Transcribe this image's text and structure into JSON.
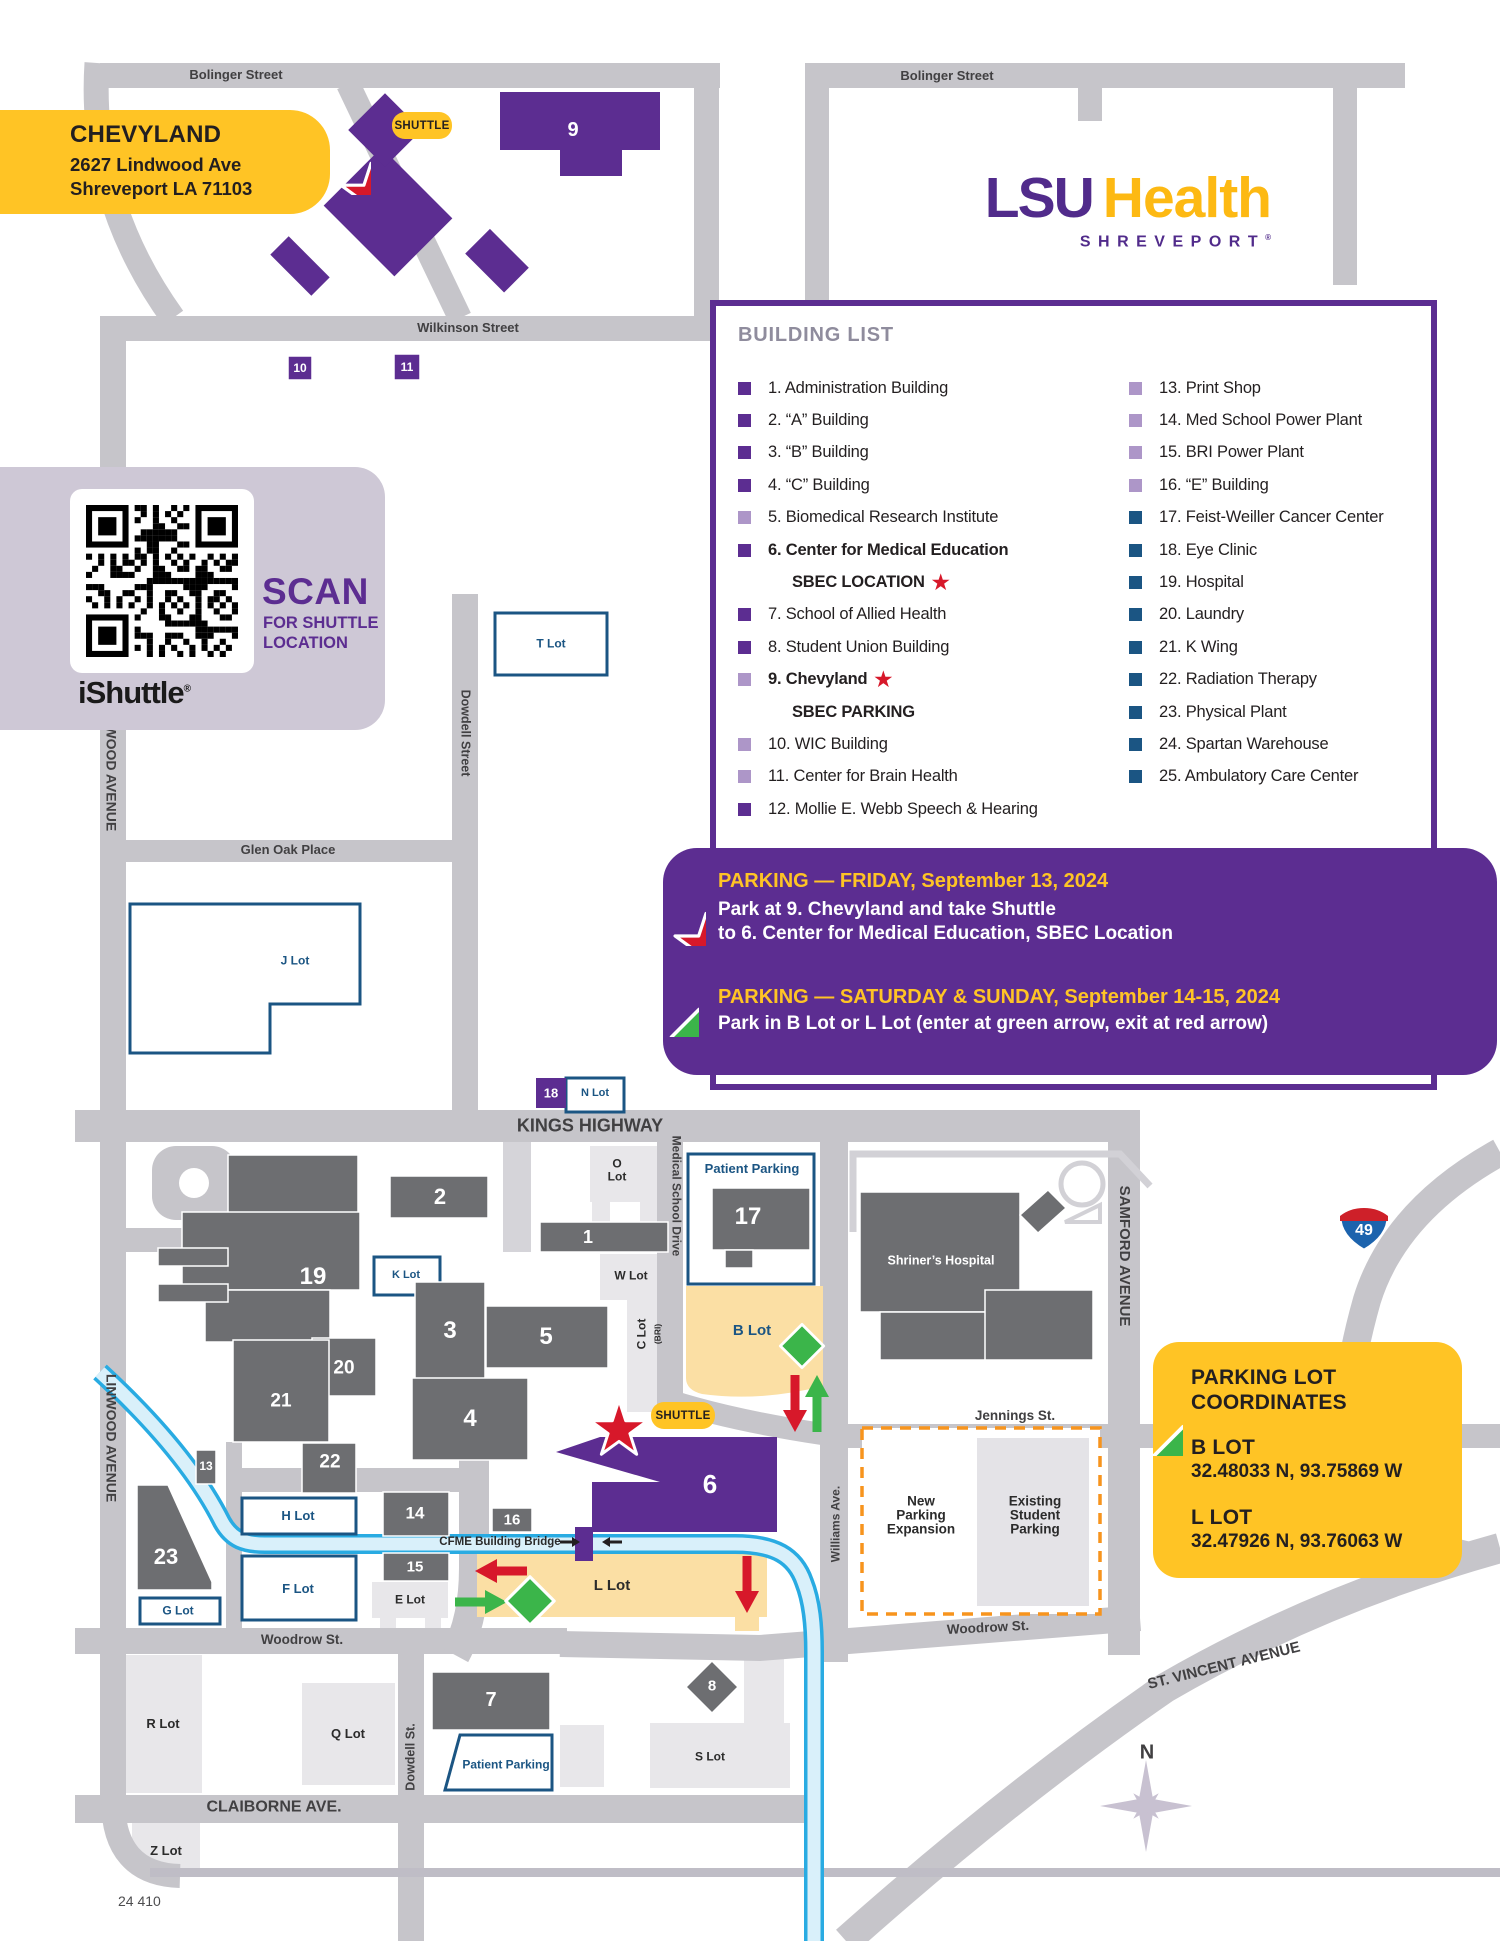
{
  "page": {
    "footer": "24 410"
  },
  "colors": {
    "purple": "#5C2D91",
    "light_purple": "#AD96C8",
    "navy": "#1B5583",
    "gold": "#FFC425",
    "logo_gold": "#FDB913",
    "red": "#D7182A",
    "green": "#3BB54A",
    "cyan": "#29ABE2",
    "orange": "#F7941D",
    "road_gray": "#C6C5CA",
    "building_gray": "#6D6E71",
    "lot_yellow": "#FBDFA4",
    "lavender": "#CEC8D6"
  },
  "logo": {
    "lsu": "LSU",
    "health": "Health",
    "sub": "SHREVEPORT",
    "reg": "®"
  },
  "callout": {
    "title": "CHEVYLAND",
    "line1": "2627 Lindwood Ave",
    "line2": "Shreveport LA 71103"
  },
  "shuttle_pill": "SHUTTLE",
  "qr_panel": {
    "scan": "SCAN",
    "sub1": "FOR SHUTTLE",
    "sub2": "LOCATION",
    "brand": "iShuttle",
    "reg": "®"
  },
  "building_list": {
    "title": "BUILDING LIST",
    "left": [
      {
        "text": "1. Administration Building",
        "bullet": "p"
      },
      {
        "text": "2. “A” Building",
        "bullet": "p"
      },
      {
        "text": "3. “B” Building",
        "bullet": "p"
      },
      {
        "text": "4. “C” Building",
        "bullet": "p"
      },
      {
        "text": "5. Biomedical Research Institute",
        "bullet": "lp"
      },
      {
        "text": "6. Center for Medical Education",
        "bullet": "p",
        "bold": true
      },
      {
        "text": "SBEC LOCATION",
        "sub": true,
        "star": true
      },
      {
        "text": "7. School of Allied Health",
        "bullet": "p"
      },
      {
        "text": "8. Student Union Building",
        "bullet": "p"
      },
      {
        "text": "9. Chevyland",
        "bullet": "lp",
        "bold": true,
        "star": true
      },
      {
        "text": "SBEC PARKING",
        "sub": true
      },
      {
        "text": "10. WIC Building",
        "bullet": "lp"
      },
      {
        "text": "11. Center for Brain Health",
        "bullet": "lp"
      },
      {
        "text": "12. Mollie E. Webb Speech & Hearing",
        "bullet": "p"
      }
    ],
    "right": [
      {
        "text": "13. Print Shop",
        "bullet": "lp"
      },
      {
        "text": "14. Med School Power Plant",
        "bullet": "lp"
      },
      {
        "text": "15. BRI Power Plant",
        "bullet": "lp"
      },
      {
        "text": "16. “E” Building",
        "bullet": "lp"
      },
      {
        "text": "17. Feist-Weiller Cancer Center",
        "bullet": "nb"
      },
      {
        "text": "18. Eye Clinic",
        "bullet": "nb"
      },
      {
        "text": "19. Hospital",
        "bullet": "nb"
      },
      {
        "text": "20. Laundry",
        "bullet": "nb"
      },
      {
        "text": "21. K Wing",
        "bullet": "nb"
      },
      {
        "text": "22. Radiation Therapy",
        "bullet": "nb"
      },
      {
        "text": "23. Physical Plant",
        "bullet": "nb"
      },
      {
        "text": "24. Spartan Warehouse",
        "bullet": "nb"
      },
      {
        "text": "25. Ambulatory Care Center",
        "bullet": "nb"
      }
    ]
  },
  "banner": {
    "friday_title": "PARKING — FRIDAY, September 13, 2024",
    "friday_line1": "Park at 9. Chevyland and take Shuttle",
    "friday_line2": "to 6. Center for Medical Education, SBEC Location",
    "weekend_title": "PARKING — SATURDAY & SUNDAY, September 14-15, 2024",
    "weekend_line1": "Park in B Lot or L Lot (enter at green arrow, exit at red arrow)"
  },
  "coords": {
    "title1": "PARKING LOT",
    "title2": "COORDINATES",
    "b_label": "B LOT",
    "b_value": "32.48033 N, 93.75869 W",
    "l_label": "L LOT",
    "l_value": "32.47926 N, 93.76063 W"
  },
  "map": {
    "labels": [
      {
        "n": "bolinger-street-label-1",
        "t": "Bolinger Street",
        "x": 236,
        "y": 75,
        "r": 0,
        "c": "st",
        "s": 13
      },
      {
        "n": "bolinger-street-label-2",
        "t": "Bolinger Street",
        "x": 947,
        "y": 76,
        "r": 0,
        "c": "st",
        "s": 13
      },
      {
        "n": "wilkinson-street-label",
        "t": "Wilkinson Street",
        "x": 468,
        "y": 328,
        "r": 0,
        "c": "st",
        "s": 13
      },
      {
        "n": "glen-oak-place-label",
        "t": "Glen Oak Place",
        "x": 288,
        "y": 850,
        "r": 0,
        "c": "st",
        "s": 13
      },
      {
        "n": "dowdell-street-label",
        "t": "Dowdell Street",
        "x": 465,
        "y": 733,
        "r": 90,
        "c": "st",
        "s": 12.5
      },
      {
        "n": "linwood-avenue-label-1",
        "t": "LINWOOD AVENUE",
        "x": 111,
        "y": 767,
        "r": 90,
        "c": "st",
        "s": 14
      },
      {
        "n": "linwood-avenue-label-2",
        "t": "LINWOOD AVENUE",
        "x": 111,
        "y": 1438,
        "r": 90,
        "c": "st",
        "s": 14
      },
      {
        "n": "kings-highway-label",
        "t": "KINGS HIGHWAY",
        "x": 590,
        "y": 1126,
        "r": 0,
        "c": "st",
        "s": 18
      },
      {
        "n": "medical-school-drive-label",
        "t": "Medical School Drive",
        "x": 676,
        "y": 1196,
        "r": 90,
        "c": "st",
        "s": 12
      },
      {
        "n": "samford-avenue-label",
        "t": "SAMFORD AVENUE",
        "x": 1124,
        "y": 1256,
        "r": 90,
        "c": "st",
        "s": 15
      },
      {
        "n": "jennings-st-label",
        "t": "Jennings St.",
        "x": 1015,
        "y": 1416,
        "r": 0,
        "c": "st",
        "s": 13.5
      },
      {
        "n": "williams-ave-label",
        "t": "Williams Ave.",
        "x": 836,
        "y": 1524,
        "r": -90,
        "c": "st",
        "s": 12
      },
      {
        "n": "woodrow-st-label-1",
        "t": "Woodrow St.",
        "x": 302,
        "y": 1640,
        "r": 0,
        "c": "st",
        "s": 13.5
      },
      {
        "n": "woodrow-st-label-2",
        "t": "Woodrow St.",
        "x": 988,
        "y": 1628,
        "r": -3,
        "c": "st",
        "s": 13.5
      },
      {
        "n": "claiborne-ave-label",
        "t": "CLAIBORNE AVE.",
        "x": 274,
        "y": 1808,
        "r": 0,
        "c": "st",
        "s": 16
      },
      {
        "n": "dowdell-st-label-2",
        "t": "Dowdell St.",
        "x": 411,
        "y": 1757,
        "r": -90,
        "c": "st",
        "s": 12.5
      },
      {
        "n": "st-vincent-avenue-label",
        "t": "ST. VINCENT AVENUE",
        "x": 1224,
        "y": 1666,
        "r": -14,
        "c": "st",
        "s": 15
      },
      {
        "n": "compass-n-label",
        "t": "N",
        "x": 1147,
        "y": 1753,
        "r": 0,
        "c": "st",
        "s": 20
      },
      {
        "n": "t-lot-label",
        "t": "T Lot",
        "x": 551,
        "y": 644,
        "r": 0,
        "c": "navy",
        "s": 12
      },
      {
        "n": "j-lot-label",
        "t": "J Lot",
        "x": 295,
        "y": 961,
        "r": 0,
        "c": "navy",
        "s": 12
      },
      {
        "n": "n-lot-label",
        "t": "N Lot",
        "x": 595,
        "y": 1094,
        "r": 0,
        "c": "navy",
        "s": 11
      },
      {
        "n": "k-lot-label",
        "t": "K Lot",
        "x": 406,
        "y": 1276,
        "r": 0,
        "c": "navy",
        "s": 11
      },
      {
        "n": "h-lot-label",
        "t": "H Lot",
        "x": 298,
        "y": 1516,
        "r": 0,
        "c": "navy",
        "s": 13
      },
      {
        "n": "f-lot-label",
        "t": "F Lot",
        "x": 298,
        "y": 1589,
        "r": 0,
        "c": "navy",
        "s": 13
      },
      {
        "n": "g-lot-label",
        "t": "G Lot",
        "x": 178,
        "y": 1611,
        "r": 0,
        "c": "navy",
        "s": 12
      },
      {
        "n": "b-lot-label",
        "t": "B Lot",
        "x": 752,
        "y": 1331,
        "r": 0,
        "c": "navy",
        "s": 15
      },
      {
        "n": "patient-parking-label-1",
        "t": "Patient Parking",
        "x": 752,
        "y": 1169,
        "r": 0,
        "c": "navy",
        "s": 13
      },
      {
        "n": "patient-parking-label-2",
        "t": "Patient Parking",
        "x": 506,
        "y": 1765,
        "r": 0,
        "c": "navy",
        "s": 12
      },
      {
        "n": "o-lot-label",
        "t": "O\nLot",
        "x": 617,
        "y": 1170,
        "r": 0,
        "c": "blk",
        "s": 12
      },
      {
        "n": "w-lot-label",
        "t": "W Lot",
        "x": 631,
        "y": 1276,
        "r": 0,
        "c": "blk",
        "s": 12
      },
      {
        "n": "c-lot-label",
        "t": "C Lot",
        "x": 642,
        "y": 1334,
        "r": -90,
        "c": "blk",
        "s": 12
      },
      {
        "n": "c-lot-bri-label",
        "t": "(BRI)",
        "x": 658,
        "y": 1334,
        "r": -90,
        "c": "blk",
        "s": 8.5
      },
      {
        "n": "l-lot-label",
        "t": "L Lot",
        "x": 612,
        "y": 1586,
        "r": 0,
        "c": "blk",
        "s": 15
      },
      {
        "n": "e-lot-label",
        "t": "E Lot",
        "x": 410,
        "y": 1600,
        "r": 0,
        "c": "blk",
        "s": 12
      },
      {
        "n": "r-lot-label",
        "t": "R Lot",
        "x": 163,
        "y": 1724,
        "r": 0,
        "c": "blk",
        "s": 13
      },
      {
        "n": "q-lot-label",
        "t": "Q Lot",
        "x": 348,
        "y": 1734,
        "r": 0,
        "c": "blk",
        "s": 13
      },
      {
        "n": "s-lot-label",
        "t": "S Lot",
        "x": 710,
        "y": 1757,
        "r": 0,
        "c": "blk",
        "s": 12
      },
      {
        "n": "z-lot-label",
        "t": "Z Lot",
        "x": 166,
        "y": 1851,
        "r": 0,
        "c": "blk",
        "s": 13
      },
      {
        "n": "cfme-bridge-label",
        "t": "CFME Building Bridge",
        "x": 500,
        "y": 1542,
        "r": 0,
        "c": "blk",
        "s": 11.5
      },
      {
        "n": "new-parking-expansion-label",
        "t": "New\nParking\nExpansion",
        "x": 921,
        "y": 1516,
        "r": 0,
        "c": "blk",
        "s": 13.5
      },
      {
        "n": "existing-student-parking-label",
        "t": "Existing\nStudent\nParking",
        "x": 1035,
        "y": 1516,
        "r": 0,
        "c": "blk",
        "s": 13.5
      },
      {
        "n": "shriners-hospital-label",
        "t": "Shriner’s Hospital",
        "x": 941,
        "y": 1261,
        "r": 0,
        "c": "wht",
        "s": 12.5
      }
    ],
    "numbers": [
      {
        "n": "building-9-number",
        "t": "9",
        "x": 573,
        "y": 130,
        "s": 20
      },
      {
        "n": "building-10-number",
        "t": "10",
        "x": 300,
        "y": 368,
        "s": 12
      },
      {
        "n": "building-11-number",
        "t": "11",
        "x": 407,
        "y": 367,
        "s": 12
      },
      {
        "n": "building-18-number",
        "t": "18",
        "x": 551,
        "y": 1093,
        "s": 13
      },
      {
        "n": "building-2-number",
        "t": "2",
        "x": 440,
        "y": 1197,
        "s": 22
      },
      {
        "n": "building-1-number",
        "t": "1",
        "x": 588,
        "y": 1237,
        "s": 18
      },
      {
        "n": "building-17-number",
        "t": "17",
        "x": 748,
        "y": 1217,
        "s": 24
      },
      {
        "n": "building-19-number",
        "t": "19",
        "x": 313,
        "y": 1277,
        "s": 24
      },
      {
        "n": "building-3-number",
        "t": "3",
        "x": 450,
        "y": 1331,
        "s": 24
      },
      {
        "n": "building-5-number",
        "t": "5",
        "x": 546,
        "y": 1337,
        "s": 24
      },
      {
        "n": "building-20-number",
        "t": "20",
        "x": 344,
        "y": 1368,
        "s": 19
      },
      {
        "n": "building-21-number",
        "t": "21",
        "x": 281,
        "y": 1401,
        "s": 19
      },
      {
        "n": "building-13-number",
        "t": "13",
        "x": 206,
        "y": 1466,
        "s": 12
      },
      {
        "n": "building-22-number",
        "t": "22",
        "x": 330,
        "y": 1462,
        "s": 19
      },
      {
        "n": "building-23-number",
        "t": "23",
        "x": 166,
        "y": 1557,
        "s": 22
      },
      {
        "n": "building-14-number",
        "t": "14",
        "x": 415,
        "y": 1513,
        "s": 17
      },
      {
        "n": "building-16-number",
        "t": "16",
        "x": 512,
        "y": 1520,
        "s": 15
      },
      {
        "n": "building-15-number",
        "t": "15",
        "x": 415,
        "y": 1567,
        "s": 15
      },
      {
        "n": "building-4-number",
        "t": "4",
        "x": 470,
        "y": 1419,
        "s": 24
      },
      {
        "n": "building-6-number",
        "t": "6",
        "x": 710,
        "y": 1484,
        "s": 26
      },
      {
        "n": "building-7-number",
        "t": "7",
        "x": 491,
        "y": 1700,
        "s": 20
      },
      {
        "n": "building-8-number",
        "t": "8",
        "x": 712,
        "y": 1686,
        "s": 15
      },
      {
        "n": "interstate-49-number",
        "t": "49",
        "x": 1364,
        "y": 1231,
        "s": 16
      }
    ]
  }
}
